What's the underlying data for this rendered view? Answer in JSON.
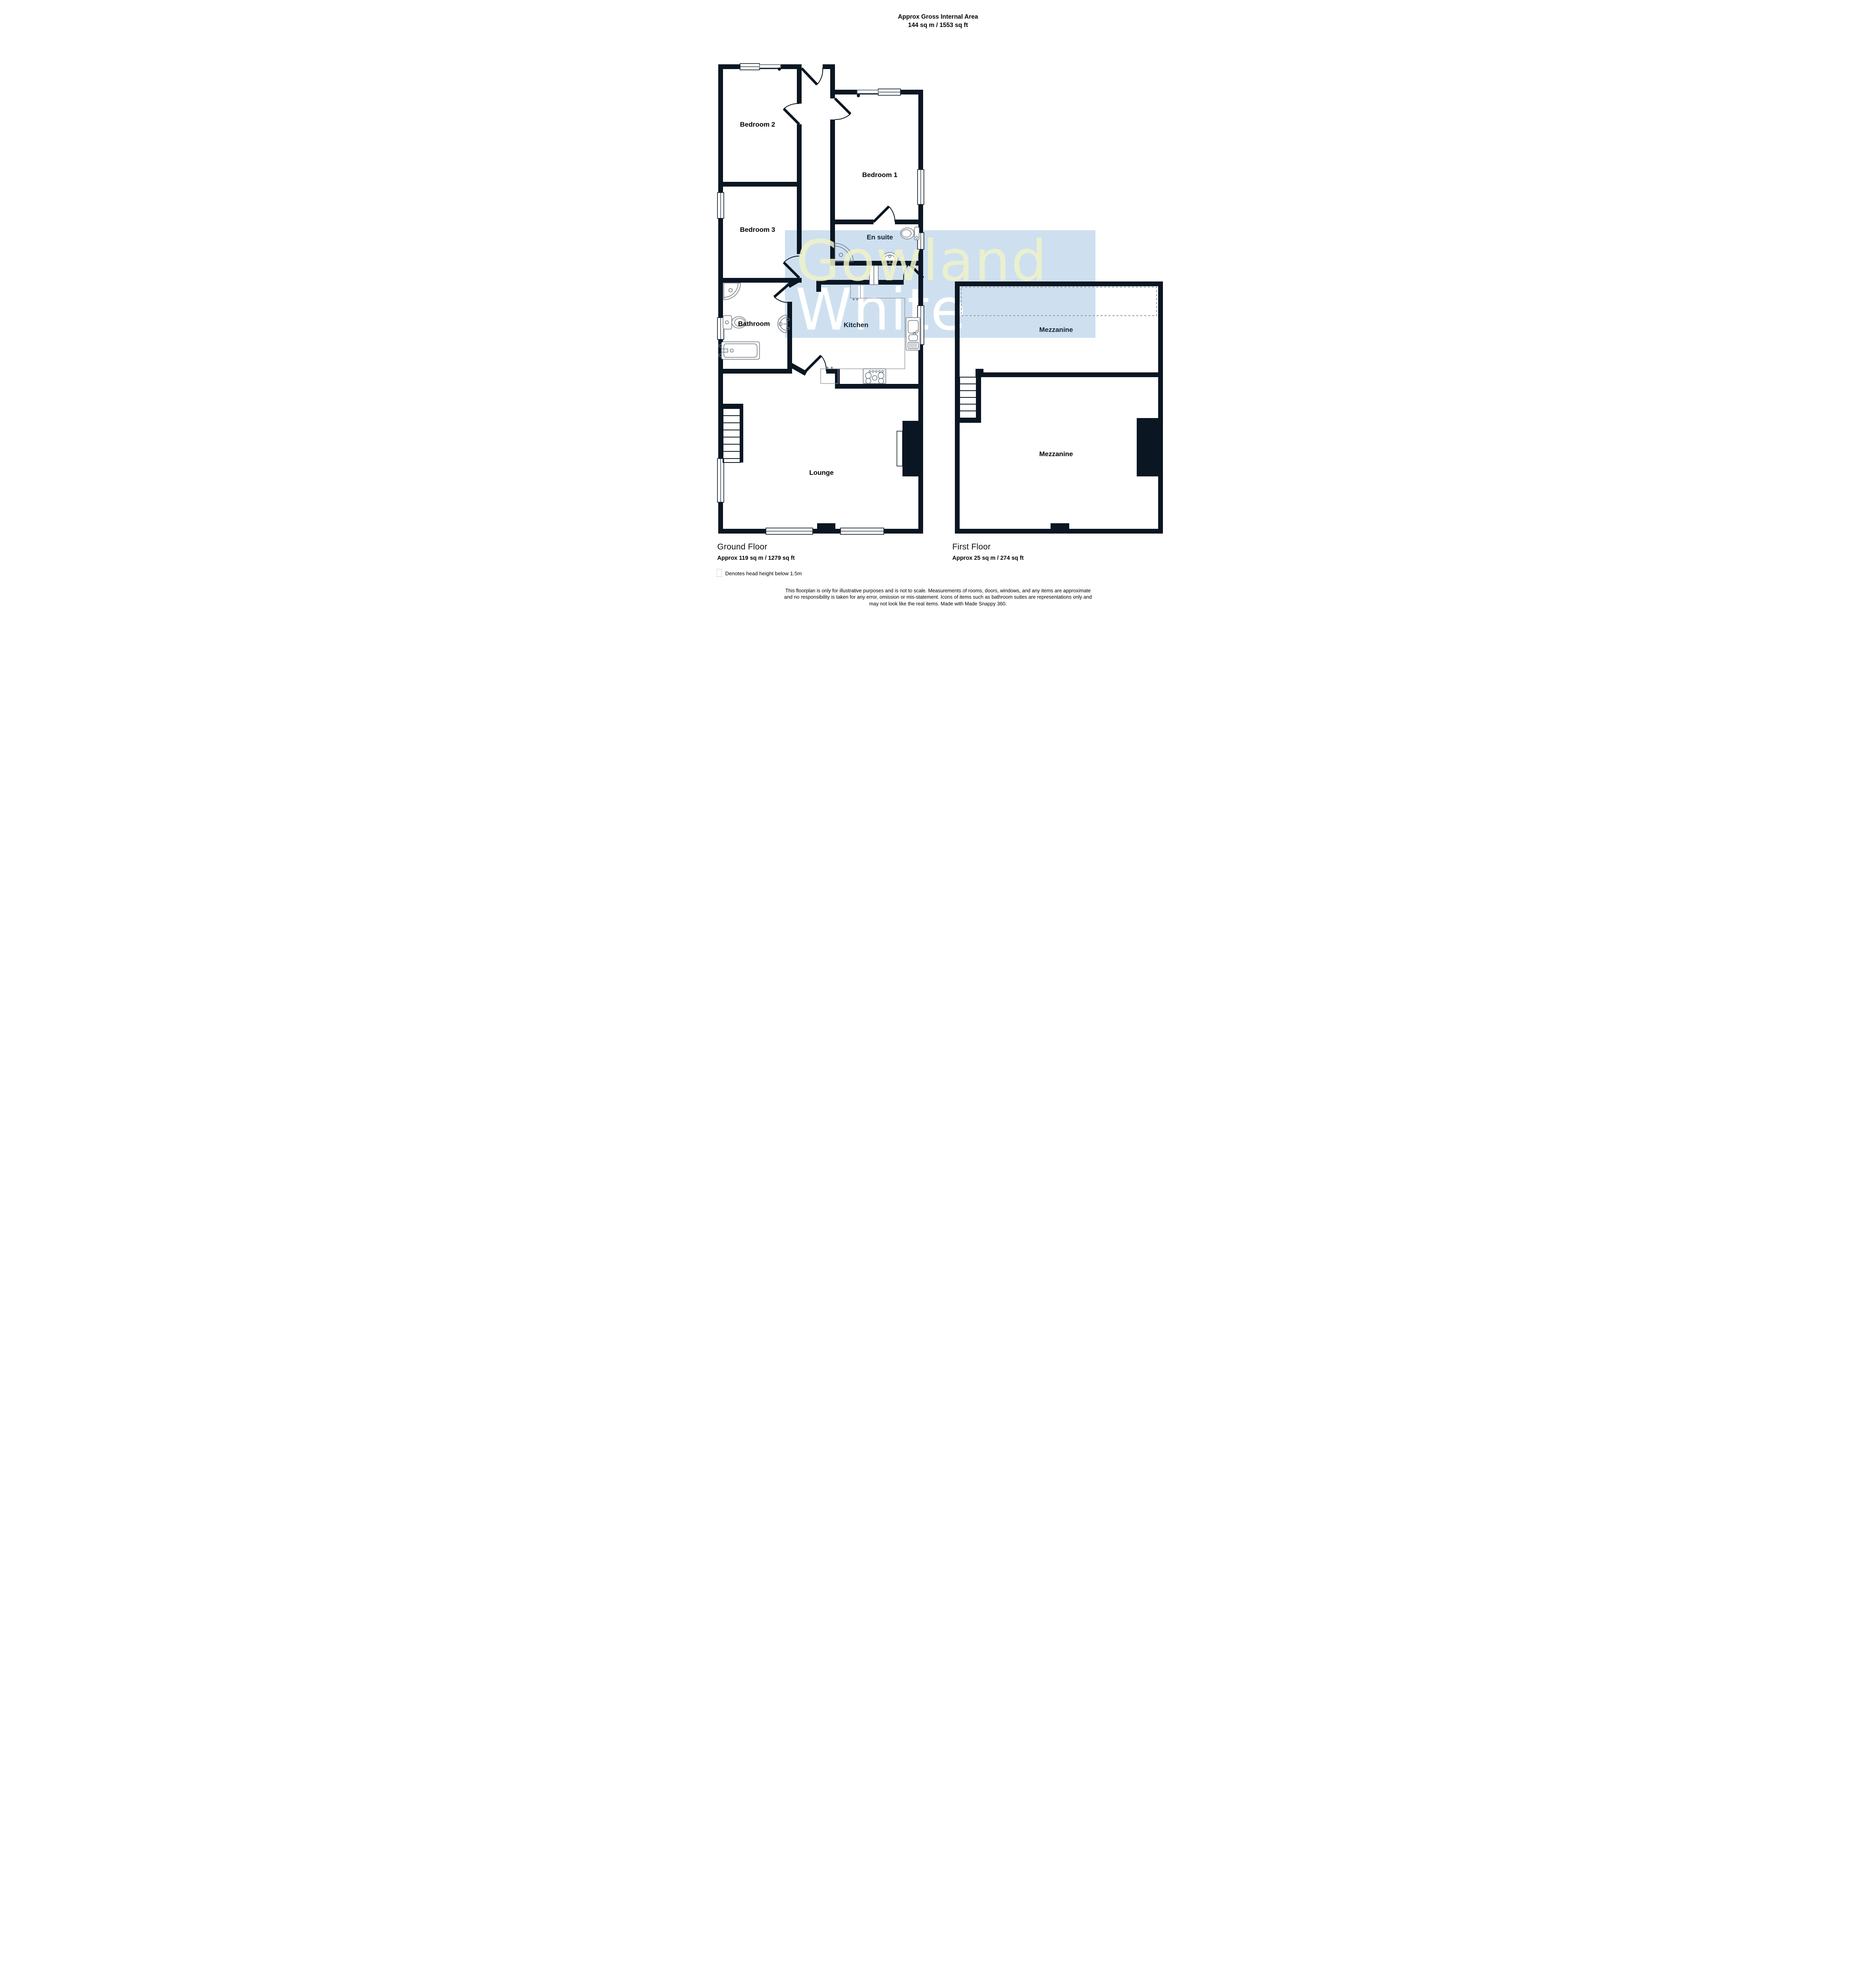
{
  "header": {
    "title_line1": "Approx Gross Internal Area",
    "title_line2": "144 sq m / 1553 sq ft"
  },
  "watermark": {
    "line1": "Gowland",
    "line2": "White"
  },
  "labels": {
    "bedroom2": "Bedroom 2",
    "bedroom1": "Bedroom 1",
    "bedroom3": "Bedroom 3",
    "ensuite": "En suite",
    "bathroom": "Bathroom",
    "kitchen": "Kitchen",
    "lounge": "Lounge",
    "mezzanine_upper": "Mezzanine",
    "mezzanine_lower": "Mezzanine"
  },
  "floors": {
    "ground": {
      "name": "Ground Floor",
      "area": "Approx 119 sq m / 1279 sq ft"
    },
    "first": {
      "name": "First Floor",
      "area": "Approx 25 sq m / 274 sq ft"
    }
  },
  "legend": {
    "text": "Denotes head height below 1.5m"
  },
  "disclaimer": {
    "line1": "This floorplan is only for illustrative purposes and is not to scale. Measurements of rooms, doors, windows, and any items are approximate",
    "line2": "and no responsibility is taken for any error, omission or mis-statement. Icons of items such as bathroom suites are representations only and",
    "line3": "may not look like the real items. Made with Made Snappy 360."
  },
  "colors": {
    "band": "#cee0f0",
    "watermark_yellow": "#eef1c8",
    "watermark_white": "#ffffff",
    "wall": "#0a1622"
  }
}
